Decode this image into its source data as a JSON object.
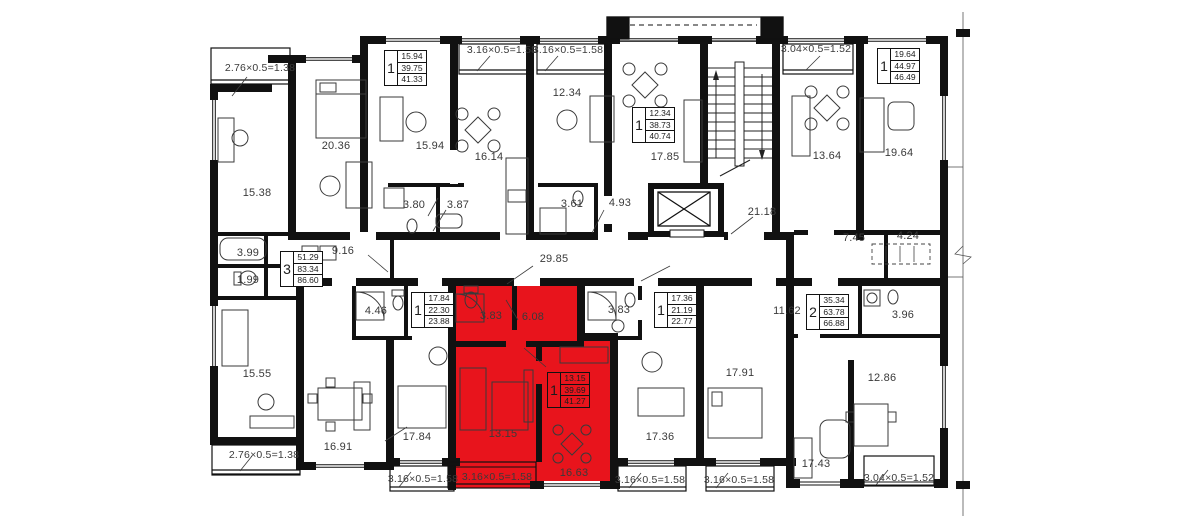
{
  "plan": {
    "title": "apartment-building-floor-plan",
    "colors": {
      "highlight": "#e8141c",
      "wall": "#111111",
      "text": "#3a3a3a",
      "background": "#ffffff"
    },
    "room_labels": [
      {
        "t": "15.38",
        "x": 257,
        "y": 193
      },
      {
        "t": "20.36",
        "x": 336,
        "y": 146
      },
      {
        "t": "15.94",
        "x": 430,
        "y": 146
      },
      {
        "t": "16.14",
        "x": 489,
        "y": 157
      },
      {
        "t": "12.34",
        "x": 567,
        "y": 93
      },
      {
        "t": "17.85",
        "x": 665,
        "y": 157
      },
      {
        "t": "21.18",
        "x": 762,
        "y": 212
      },
      {
        "t": "13.64",
        "x": 827,
        "y": 156
      },
      {
        "t": "19.64",
        "x": 899,
        "y": 153
      },
      {
        "t": "3.80",
        "x": 414,
        "y": 205
      },
      {
        "t": "3.87",
        "x": 458,
        "y": 205
      },
      {
        "t": "3.61",
        "x": 572,
        "y": 204
      },
      {
        "t": "4.93",
        "x": 620,
        "y": 203
      },
      {
        "t": "29.85",
        "x": 554,
        "y": 259
      },
      {
        "t": "7.45",
        "x": 854,
        "y": 238
      },
      {
        "t": "4.24",
        "x": 908,
        "y": 236
      },
      {
        "t": "3.99",
        "x": 248,
        "y": 253
      },
      {
        "t": "1.99",
        "x": 248,
        "y": 280
      },
      {
        "t": "9.16",
        "x": 343,
        "y": 251
      },
      {
        "t": "4.46",
        "x": 376,
        "y": 311
      },
      {
        "t": "3.83",
        "x": 491,
        "y": 316
      },
      {
        "t": "6.08",
        "x": 533,
        "y": 317
      },
      {
        "t": "3.83",
        "x": 619,
        "y": 310
      },
      {
        "t": "11.62",
        "x": 787,
        "y": 311
      },
      {
        "t": "3.96",
        "x": 903,
        "y": 315
      },
      {
        "t": "15.55",
        "x": 257,
        "y": 374
      },
      {
        "t": "16.91",
        "x": 338,
        "y": 447
      },
      {
        "t": "17.84",
        "x": 417,
        "y": 437
      },
      {
        "t": "13.15",
        "x": 503,
        "y": 434
      },
      {
        "t": "16.63",
        "x": 574,
        "y": 473
      },
      {
        "t": "17.36",
        "x": 660,
        "y": 437
      },
      {
        "t": "17.91",
        "x": 740,
        "y": 373
      },
      {
        "t": "12.86",
        "x": 882,
        "y": 378
      },
      {
        "t": "17.43",
        "x": 816,
        "y": 464
      }
    ],
    "balcony_labels": [
      {
        "t": "2.76×0.5=1.38",
        "x": 260,
        "y": 68
      },
      {
        "t": "3.16×0.5=1.58",
        "x": 502,
        "y": 50
      },
      {
        "t": "3.16×0.5=1.58",
        "x": 568,
        "y": 50
      },
      {
        "t": "3.04×0.5=1.52",
        "x": 816,
        "y": 49
      },
      {
        "t": "2.76×0.5=1.38",
        "x": 264,
        "y": 455
      },
      {
        "t": "3.16×0.5=1.58",
        "x": 423,
        "y": 479
      },
      {
        "t": "3.16×0.5=1.58",
        "x": 497,
        "y": 477
      },
      {
        "t": "3.16×0.5=1.58",
        "x": 650,
        "y": 480
      },
      {
        "t": "3.16×0.5=1.58",
        "x": 739,
        "y": 480
      },
      {
        "t": "3.04×0.5=1.52",
        "x": 899,
        "y": 478
      }
    ],
    "apartment_tables": [
      {
        "rooms": "1",
        "living": "15.94",
        "area": "39.75",
        "total": "41.33",
        "x": 384,
        "y": 50,
        "highlight": false
      },
      {
        "rooms": "1",
        "living": "12.34",
        "area": "38.73",
        "total": "40.74",
        "x": 632,
        "y": 107,
        "highlight": false
      },
      {
        "rooms": "1",
        "living": "19.64",
        "area": "44.97",
        "total": "46.49",
        "x": 877,
        "y": 48,
        "highlight": false
      },
      {
        "rooms": "3",
        "living": "51.29",
        "area": "83.34",
        "total": "86.60",
        "x": 280,
        "y": 251,
        "highlight": false
      },
      {
        "rooms": "1",
        "living": "17.84",
        "area": "22.30",
        "total": "23.88",
        "x": 411,
        "y": 292,
        "highlight": false
      },
      {
        "rooms": "1",
        "living": "17.36",
        "area": "21.19",
        "total": "22.77",
        "x": 654,
        "y": 292,
        "highlight": false
      },
      {
        "rooms": "2",
        "living": "35.34",
        "area": "63.78",
        "total": "66.88",
        "x": 806,
        "y": 294,
        "highlight": false
      },
      {
        "rooms": "1",
        "living": "13.15",
        "area": "39.69",
        "total": "41.27",
        "x": 547,
        "y": 372,
        "highlight": true
      }
    ],
    "selected_apartment": {
      "rooms": "1",
      "living_area": "13.15",
      "area": "39.69",
      "total_area": "41.27",
      "room_areas": {
        "living": "13.15",
        "kitchen": "16.63",
        "hall": "6.08",
        "bathroom": "3.83",
        "balcony": "3.16×0.5=1.58"
      }
    }
  }
}
